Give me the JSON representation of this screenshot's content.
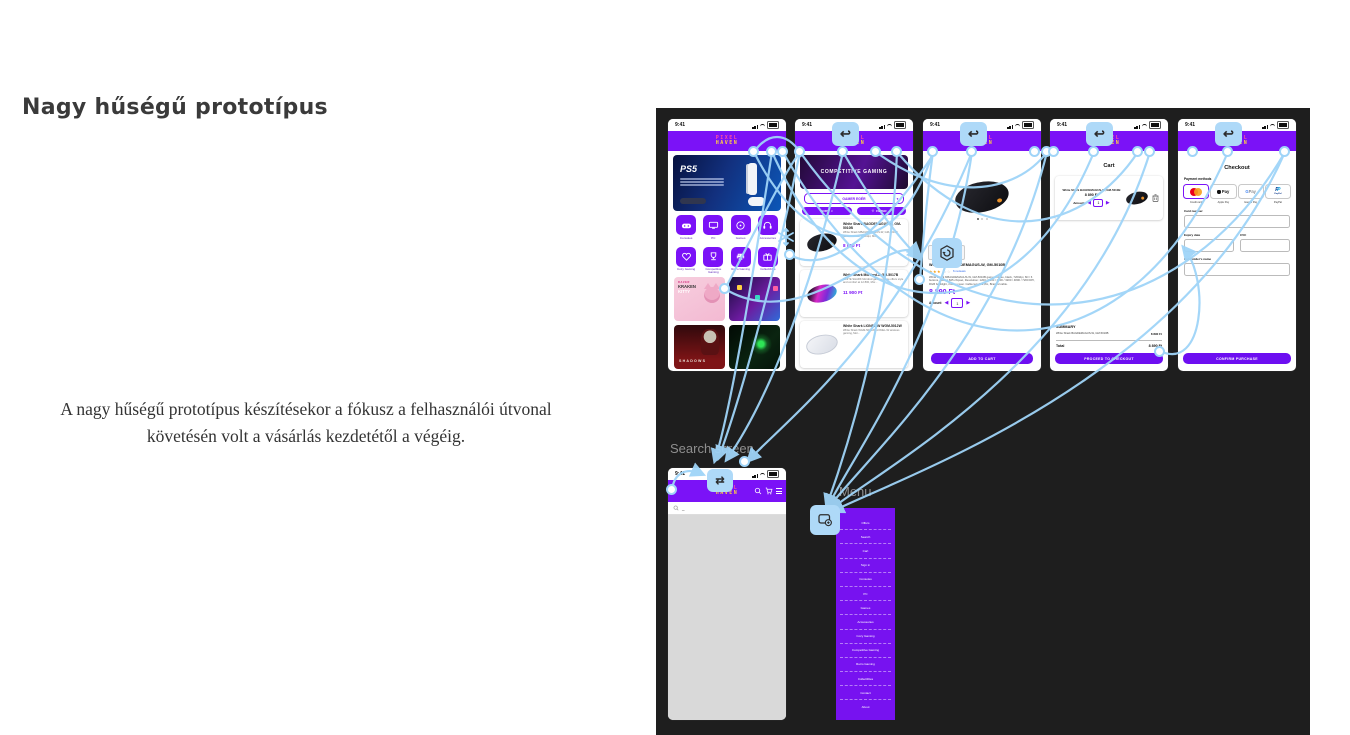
{
  "page": {
    "title": "Nagy hűségű prototípus",
    "body": "A nagy hűségű prototípus készítésekor a fókusz a felhasználói útvonal követésén volt a vásárlás kezdetétől a végéig."
  },
  "canvas": {
    "labels": {
      "search": "Search screen",
      "menu": "Menu"
    }
  },
  "status": {
    "time": "9:41"
  },
  "brand": {
    "line1": "PIXEL",
    "line2": "HAVEN"
  },
  "icons": {
    "chevron_down": "▼",
    "heart": "♡",
    "back": "↩",
    "swap": "⇄",
    "left_tri": "◀",
    "right_tri": "▶"
  },
  "home": {
    "banner_title": "PS5",
    "categories": [
      "Consoles",
      "PC",
      "Games",
      "Accessories",
      "Cozy Gaming",
      "Competitive Gaming",
      "Retro Gaming",
      "Collectibles"
    ],
    "cards": {
      "kitty_brand": "RAZER",
      "kitty_line1": "KRAKEN",
      "kitty_line2": "KITTY",
      "shadows_label": "SHADOWS"
    }
  },
  "category": {
    "banner": "COMPETITIVE GAMING",
    "dropdown_value": "GAMER EGÉR",
    "sort_label": "SORT",
    "filter_label": "FILTER",
    "products": [
      {
        "name": "White Shark BAGDEMAGUS-W, GM-5010B",
        "desc": "White Shark MBAGDEMAGUS-W, GM-5010B gamer mouse, 7200dpi, Mor...",
        "price": "8 890 Ft"
      },
      {
        "name": "White Shark Mordred-B GM-5017B",
        "desc": "WHITE SHARK Mordred gamer mouse offers style and comfort at 12 800, Mor...",
        "price": "11 900 Ft"
      },
      {
        "name": "White Shark LIONEL-W WGM-5012W",
        "desc": "White Shark WGM-5012W, LIONEL-W wireless gaming, Mor...",
        "price": ""
      }
    ]
  },
  "product": {
    "name": "White Shark BAGDEMAGUS-W, GM-5010B",
    "stars_filled": "★★★",
    "stars_empty": "☆☆",
    "reviews": "6 reviews",
    "desc": "White Shark MBAGDEMAGUS-W, GM-5010B gamer mouse, black, 7200dpi, 6D / 6 buttons, Instant 825 chipset, Resolution: 1200 / 1600 / 2400 / 3200 / 4800 / 7200 DPI, RGB backlight, rubber cover. Cable lenght:1,8m, Braided cable.",
    "price": "8 890 Ft",
    "amount_label": "Amount",
    "amount_value": "1",
    "add_to_cart": "ADD TO CART"
  },
  "cart": {
    "title": "Cart",
    "item": {
      "name": "White Shark BAGDEMAGUS-W, GM-5010B",
      "price": "8 890 Ft",
      "amount_label": "Amount",
      "amount_value": "1"
    },
    "summary_label": "SUMMARY",
    "summary_item": {
      "name": "White Shark BAGDEMAGUS-W, GM-5010B",
      "price": "8 890 Ft"
    },
    "total_label": "Total",
    "total_value": "8 890 Ft",
    "checkout_button": "PROCEED TO CHECKOUT"
  },
  "checkout": {
    "title": "Checkout",
    "payment_methods_label": "Payment methods",
    "methods": [
      "Credit card",
      "Apple Pay",
      "Google Pay",
      "PayPal"
    ],
    "applepay_text": "Pay",
    "gpay_g": "G",
    "gpay_text": "Pay",
    "paypal_p1": "P",
    "paypal_p2": "P",
    "paypal_text": "PayPal",
    "card_number_label": "Card number",
    "expiry_label": "Expiry date",
    "cvc_label": "CVC",
    "cardholder_label": "Cardholder's name",
    "confirm_button": "CONFIRM PURCHASE"
  },
  "menu": {
    "items": [
      "Offers",
      "Search",
      "Cart",
      "Sign in",
      "Consoles",
      "PC",
      "Games",
      "Accessories",
      "Cozy Gaming",
      "Competitive Gaming",
      "Retro Gaming",
      "Collectibles",
      "Contact",
      "About"
    ]
  },
  "colors": {
    "accent_purple": "#7b12f7",
    "button_purple": "#6d0ef1",
    "connector_blue": "#9fd4f8",
    "canvas_bg": "#1e1e1e"
  }
}
